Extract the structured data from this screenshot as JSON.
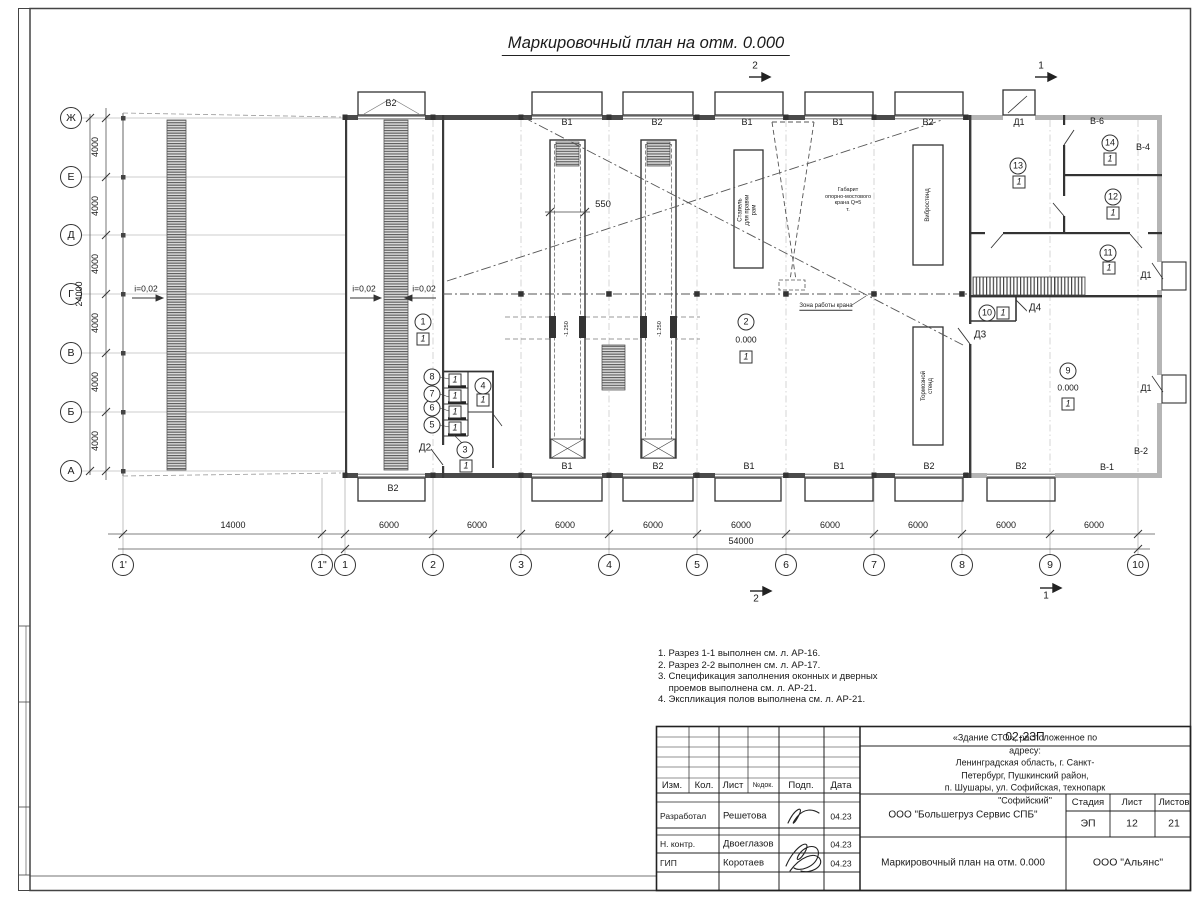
{
  "title": "Маркировочный план на отм. 0.000",
  "sections": {
    "one": "1",
    "two": "2"
  },
  "axes": {
    "rows": [
      "Ж",
      "Е",
      "Д",
      "Г",
      "В",
      "Б",
      "А"
    ],
    "cols": [
      "1'",
      "1\"",
      "1",
      "2",
      "3",
      "4",
      "5",
      "6",
      "7",
      "8",
      "9",
      "10"
    ]
  },
  "dims": {
    "first": "14000",
    "bay": "6000",
    "total": "54000",
    "row": "4000",
    "height": "24000",
    "pit": "550"
  },
  "slope": "i=0,02",
  "levels": {
    "zero": "0.000",
    "pit": "-1.250"
  },
  "marks": {
    "floor": "1",
    "gates_top": [
      "В2",
      "В1",
      "В2",
      "В1",
      "В1",
      "В2"
    ],
    "gates_bottom": [
      "В2",
      "В1",
      "В2",
      "В1",
      "В1",
      "В2",
      "В2"
    ],
    "vents": {
      "v1": "В-1",
      "v2": "В-2",
      "v4": "В-4",
      "v6": "В-6"
    },
    "doors": {
      "d1": "Д1",
      "d2": "Д2",
      "d3": "Д3",
      "d4": "Д4"
    },
    "rooms": [
      "1",
      "2",
      "3",
      "4",
      "5",
      "6",
      "7",
      "8",
      "9",
      "10",
      "11",
      "12",
      "13",
      "14"
    ]
  },
  "equipment": {
    "stapel": "Стапель\nдля правки\nрам",
    "vibro": "Вибростенд",
    "tormoz": "Тормозной\nстенд",
    "crane": "Габарит\nопорно-мостового\nкрана Q=5\nт.",
    "zone": "Зона работы крана"
  },
  "notes": [
    "1. Разрез 1-1 выполнен см. л. АР-16.",
    "2. Разрез 2-2 выполнен см. л. АР-17.",
    "3. Спецификация заполнения оконных и дверных\n    проемов выполнена см. л. АР-21.",
    "4. Экспликация полов выполнена см. л. АР-21."
  ],
  "titleblock": {
    "code": "02-23П",
    "object": "«Здание СТО», расположенное по адресу:\nЛенинградская область, г. Санкт-Петербург, Пушкинский район,\nп. Шушары, ул. Софийская, технопарк \"Софийский\"",
    "hdr": {
      "izm": "Изм.",
      "kol": "Кол.",
      "list": "Лист",
      "ndok": "№док.",
      "podp": "Подп.",
      "data": "Дата"
    },
    "staff": [
      {
        "role": "Разработал",
        "name": "Решетова",
        "date": "04.23"
      },
      {
        "role": "Н. контр.",
        "name": "Двоеглазов",
        "date": "04.23"
      },
      {
        "role": "ГИП",
        "name": "Коротаев",
        "date": "04.23"
      }
    ],
    "company": "ООО \"Большегруз Сервис СПБ\"",
    "stage_l": "Стадия",
    "sheet_l": "Лист",
    "sheets_l": "Листов",
    "stage": "ЭП",
    "sheet": "12",
    "sheets": "21",
    "name": "Маркировочный план на отм. 0.000",
    "firm": "ООО \"Альянс\""
  }
}
